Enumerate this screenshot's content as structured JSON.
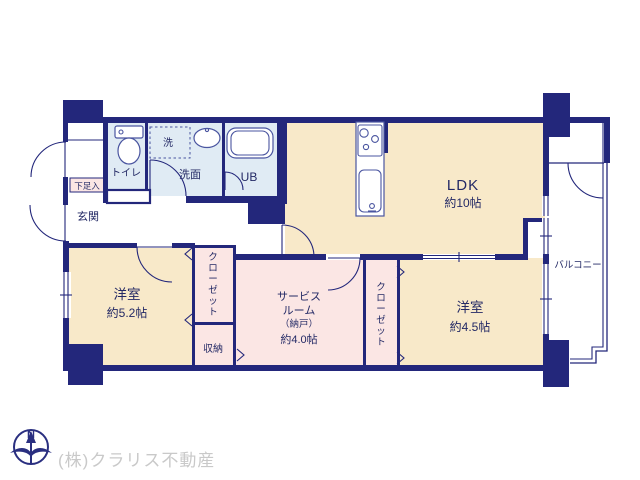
{
  "colors": {
    "wall_navy": "#23277b",
    "text_navy": "#232965",
    "room_cream": "#f8e9c9",
    "room_pink": "#fbe6e4",
    "room_blue": "#e0ebf4",
    "company_gray": "#c9c9c9"
  },
  "rooms": {
    "ldk": {
      "name": "LDK",
      "size": "約10帖"
    },
    "bedroom52": {
      "name": "洋室",
      "size": "約5.2帖"
    },
    "bedroom45": {
      "name": "洋室",
      "size": "約4.5帖"
    },
    "service": {
      "line1": "サービス",
      "line2": "ルーム",
      "line3": "（納戸）",
      "size": "約4.0帖"
    },
    "closet_left": {
      "name": "クローゼット"
    },
    "closet_right": {
      "name": "クローゼット"
    },
    "storage": {
      "name": "収納"
    },
    "toilet": {
      "name": "トイレ"
    },
    "washroom": {
      "name": "洗面"
    },
    "laundry": {
      "name": "洗"
    },
    "bath": {
      "name": "UB"
    },
    "entrance": {
      "name": "玄関"
    },
    "shoe": {
      "name": "下足入"
    },
    "balcony": {
      "name": "バルコニー"
    }
  },
  "compass": {
    "north": "N"
  },
  "footer": {
    "company": "(株)クラリス不動産"
  }
}
